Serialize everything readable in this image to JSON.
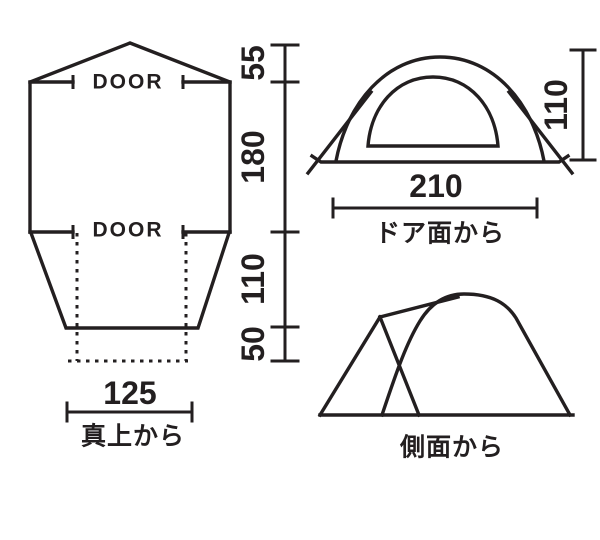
{
  "page": {
    "bg": "#ffffff",
    "ink": "#231f20"
  },
  "top_view": {
    "door_top": "DOOR",
    "door_bottom": "DOOR",
    "dims": {
      "peak_depth": "55",
      "body_depth": "180",
      "taper_depth": "110",
      "porch_depth": "50",
      "porch_width": "125"
    },
    "caption": "真上から"
  },
  "front_view": {
    "dims": {
      "width": "210",
      "height": "110"
    },
    "caption": "ドア面から"
  },
  "side_view": {
    "caption": "側面から"
  }
}
